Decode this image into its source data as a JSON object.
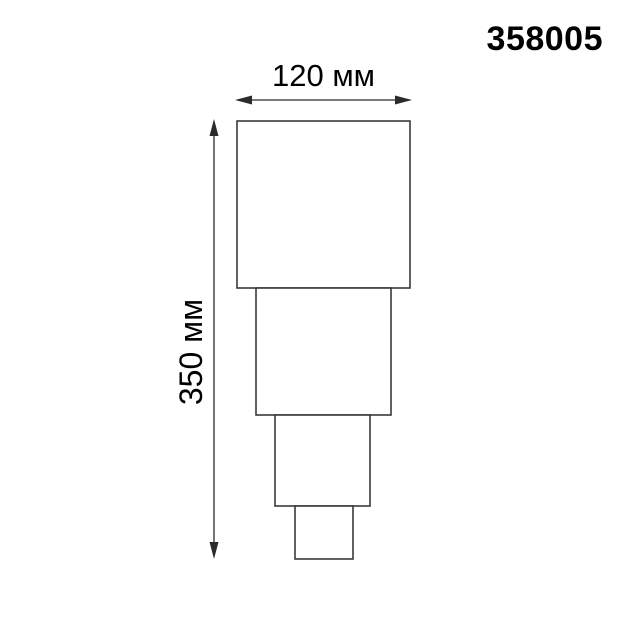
{
  "page": {
    "background": "#ffffff"
  },
  "product": {
    "code": "358005"
  },
  "dimensions": {
    "width": {
      "label": "120 мм",
      "value_mm": 120
    },
    "height": {
      "label": "350 мм",
      "value_mm": 350
    }
  },
  "colors": {
    "outline": "#3a3a3a",
    "arrow": "#2b2b2b",
    "text": "#000000"
  },
  "figure": {
    "description": "side view of stepped fixture, four tiers narrowing downward",
    "tiers": [
      {
        "x": 237,
        "y": 121,
        "width": 173,
        "height": 167
      },
      {
        "x": 256,
        "y": 288,
        "width": 135,
        "height": 127
      },
      {
        "x": 275,
        "y": 415,
        "width": 95,
        "height": 91
      },
      {
        "x": 295,
        "y": 506,
        "width": 58,
        "height": 53
      }
    ],
    "width_arrow": {
      "x1": 235,
      "x2": 412,
      "y": 100
    },
    "height_arrow": {
      "y1": 119,
      "y2": 559,
      "x": 214
    }
  }
}
